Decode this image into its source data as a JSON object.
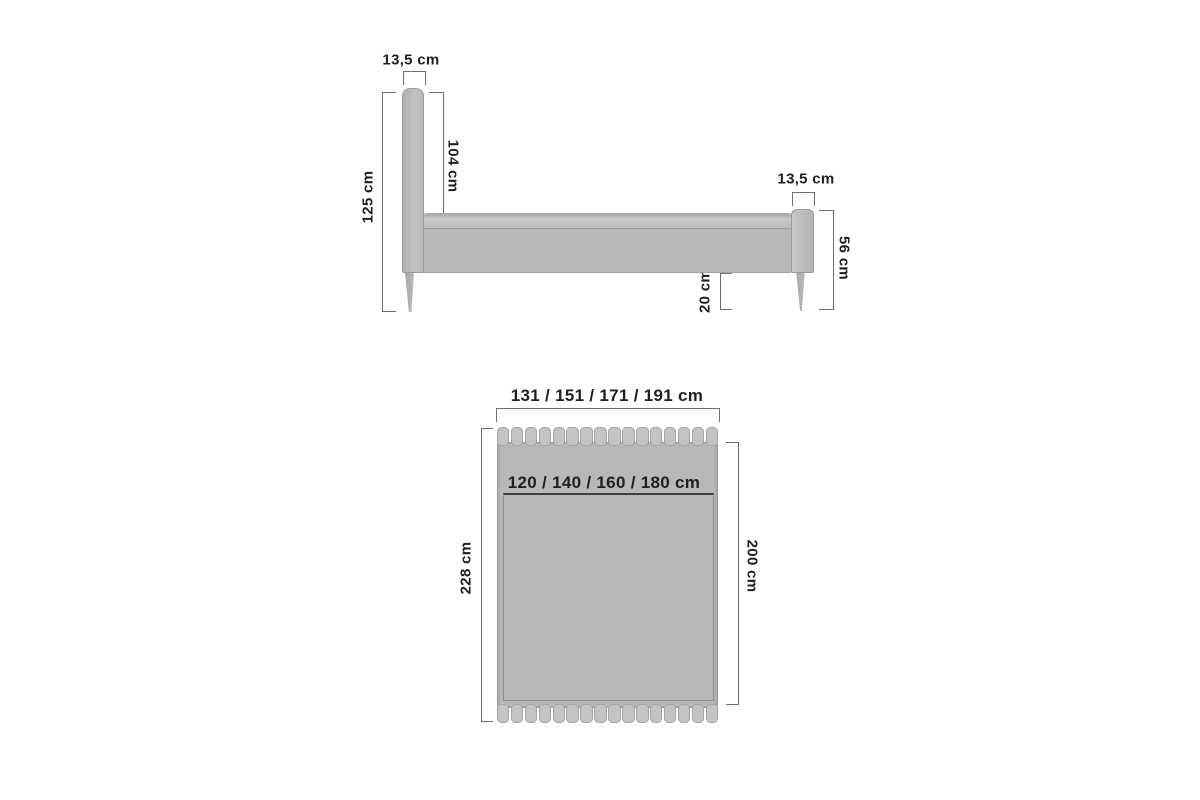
{
  "side_view": {
    "headboard_thickness_label": "13,5 cm",
    "total_height_label": "125 cm",
    "headboard_panel_height_label": "104 cm",
    "frame_side_height_label": "26 cm",
    "footboard_thickness_label": "13,5 cm",
    "footboard_height_label": "56 cm",
    "underbed_clearance_label": "20 cm"
  },
  "top_view": {
    "overall_width_label": "131 / 151 / 171 / 191 cm",
    "mattress_width_label": "120 / 140 / 160 / 180 cm",
    "overall_length_label": "228 cm",
    "mattress_length_label": "200 cm",
    "tufting_segments": 16
  },
  "colors": {
    "background": "#ffffff",
    "upholstery": "#b8b8b8",
    "upholstery_light": "#c6c6c6",
    "outline": "#9a9a9a",
    "dimension_line": "#6e6e6e",
    "text": "#1f1f1f"
  }
}
